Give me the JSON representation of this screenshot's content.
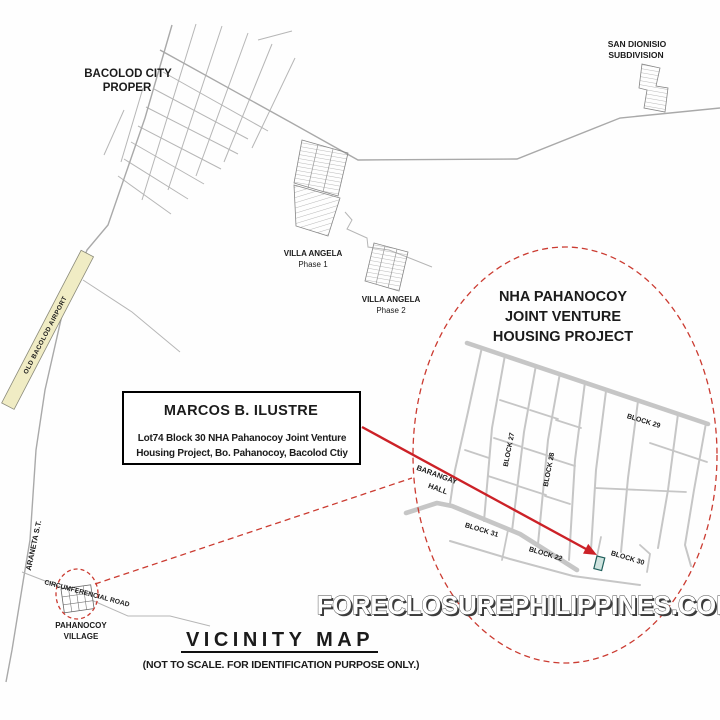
{
  "map": {
    "labels": {
      "bacolod_city_line1": "BACOLOD CITY",
      "bacolod_city_line2": "PROPER",
      "san_dionisio_line1": "SAN DIONISIO",
      "san_dionisio_line2": "SUBDIVISION",
      "villa_angela1_line1": "VILLA ANGELA",
      "villa_angela1_line2": "Phase 1",
      "villa_angela2_line1": "VILLA ANGELA",
      "villa_angela2_line2": "Phase 2",
      "old_airport": "OLD BACOLOD AIRPORT",
      "araneta_st": "ARANETA S.T.",
      "circumferencial_road": "CIRCUMFERENCIAL ROAD",
      "pahanocoy_village_line1": "PAHANOCOY",
      "pahanocoy_village_line2": "VILLAGE",
      "barangay_hall_line1": "BARANGAY",
      "barangay_hall_line2": "HALL",
      "nha_line1": "NHA PAHANOCOY",
      "nha_line2": "JOINT VENTURE",
      "nha_line3": "HOUSING PROJECT",
      "block27": "BLOCK 27",
      "block28": "BLOCK 28",
      "block29": "BLOCK 29",
      "block30": "BLOCK 30",
      "block31": "BLOCK 31",
      "block22": "BLOCK 22"
    },
    "info_box": {
      "title": "MARCOS B. ILUSTRE",
      "line1": "Lot74  Block 30 NHA Pahanocoy Joint Venture",
      "line2": "Housing Project, Bo. Pahanocoy, Bacolod Ctiy"
    },
    "title": "VICINITY MAP",
    "subtitle": "(NOT TO SCALE. FOR IDENTIFICATION PURPOSE ONLY.)",
    "watermark": "FORECLOSUREPHILIPPINES.COM",
    "colors": {
      "highlight_red": "#cc2127",
      "dashed_red": "#cb3b31",
      "road_gray": "#c6c6c6",
      "street_thin_gray": "#b6b6b6",
      "airport_strip_fill": "#f0ecc4",
      "lot_marker_fill": "#cfe3df",
      "lot_marker_stroke": "#1f5f5b",
      "text_dark": "#1b1b1b"
    }
  }
}
